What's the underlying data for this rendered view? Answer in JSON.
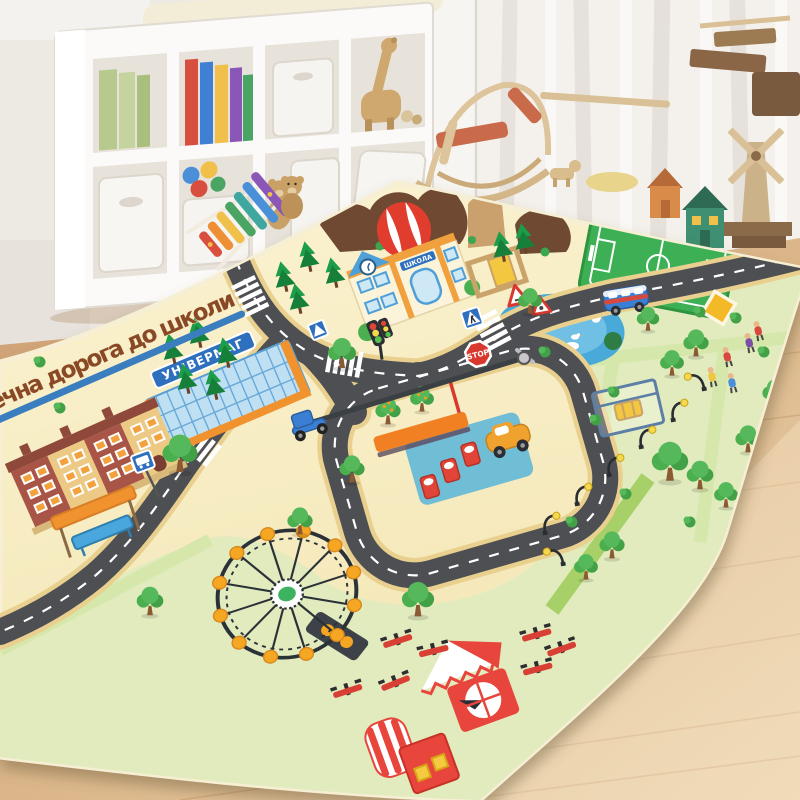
{
  "scene": {
    "description": "Photo of a children's city-roads play mat on a wooden floor in a nursery",
    "mat": {
      "title_text": "ечна дорога до школи",
      "store_sign": "УНІВЕРМАГ",
      "school_sign": "ШКОЛА",
      "stop_sign": "STOP",
      "colors": {
        "base": "#f9efc6",
        "grass": "#e1ebbe",
        "path": "#d6e7ab",
        "hedge": "#a8d068",
        "road": "#4e4f52",
        "road_edge": "#e9d08f",
        "marking": "#ffffff",
        "title": "#8a4a28",
        "ribbon": "#3b7ec0",
        "pond": "#49a9d9",
        "field": "#3cb054",
        "balloon": "#e03c2f",
        "hill": "#6f4a33",
        "brick": "#a85546",
        "tan_wall": "#ecca85",
        "orange_trim": "#f0922f",
        "sign_blue": "#2e6fbe",
        "stop_red": "#d8382e",
        "ferris_ring": "#2b3038",
        "ferris_pod": "#f5a623",
        "tent_red": "#e8453c",
        "lamp_light": "#f5d94e"
      },
      "landmarks": [
        "school",
        "department store",
        "brick houses",
        "bus stop",
        "gas station loop",
        "soccer field",
        "pond",
        "park with swing",
        "ferris wheel",
        "circus tent",
        "picnic tables",
        "hot air balloon",
        "stop sign",
        "traffic light",
        "crosswalks"
      ]
    },
    "room": {
      "wall": "#edeae4",
      "curtain": "#f4f1ec",
      "floor": "#d2a478",
      "floor_light": "#ecd6b2",
      "shelf": "#fbfaf8",
      "toys": [
        "green books",
        "picture books",
        "storage bins",
        "wooden giraffe",
        "toy balls",
        "teddy bear",
        "rainbow xylophone",
        "wooden rocking toy",
        "wooden toy houses",
        "wooden windmill",
        "toy scooter on mat"
      ]
    }
  }
}
